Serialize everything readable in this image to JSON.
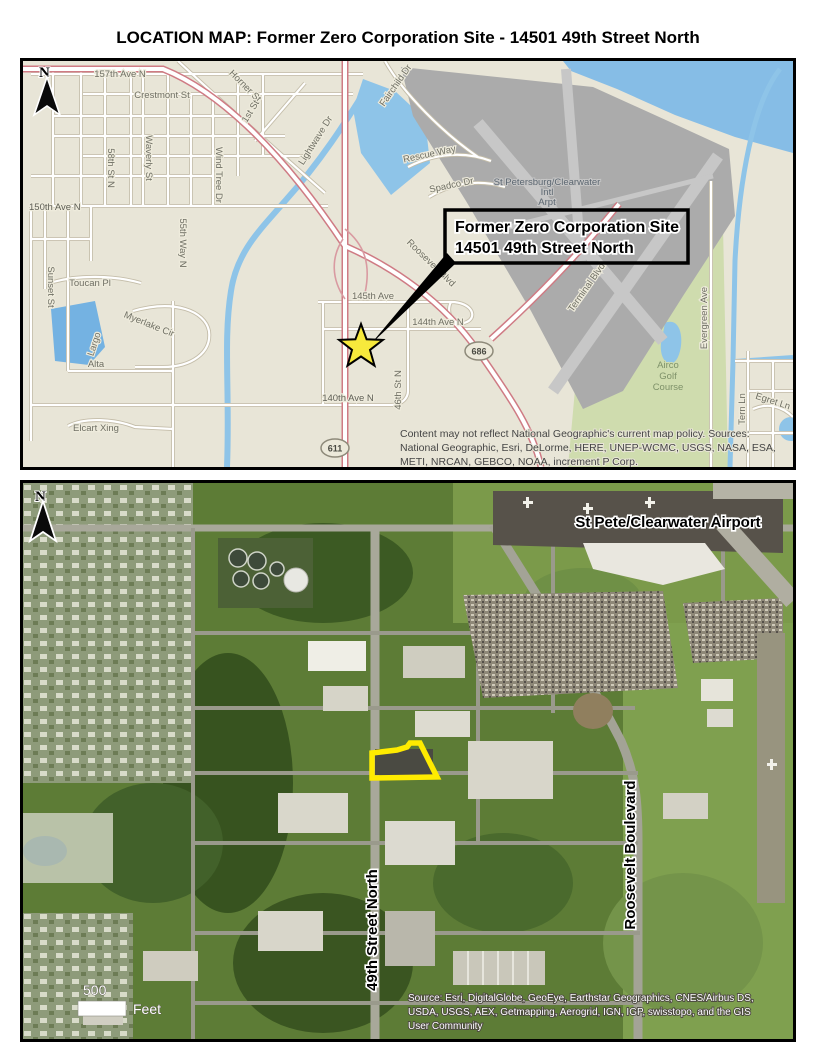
{
  "page": {
    "title": "LOCATION MAP: Former Zero Corporation Site - 14501 49th Street North"
  },
  "colors": {
    "site_outline": "#ffeb00",
    "water": "#86bde6",
    "airport_gray": "#ababab",
    "map_bg": "#e8e5d7",
    "highway_red": "#cf7b84"
  },
  "map1": {
    "north_label": "N",
    "callout": {
      "line1": "Former Zero Corporation Site",
      "line2": "14501 49th Street North"
    },
    "shields": {
      "s686": "686",
      "s611": "611"
    },
    "labels": {
      "ave_157th": "157th Ave N",
      "crestmont": "Crestmont St",
      "horner": "Horner St",
      "first_st": "1st St",
      "st_58th": "58th St N",
      "waverly": "Waverly St",
      "wind_tree": "Wind Tree Dr",
      "way_55th": "55th Way N",
      "ave_150th": "150th Ave N",
      "sunset": "Sunset St",
      "toucan": "Toucan Pl",
      "myerlake": "Myerlake Cir",
      "largo": "Largo",
      "alta": "Alta",
      "elcart": "Elcart Xing",
      "ave_140th": "140th Ave N",
      "st_46th": "46th St N",
      "ave_145th": "145th Ave",
      "ave_144th": "144th Ave N",
      "lightwave": "Lightwave Dr",
      "fairchild": "Fairchild Dr",
      "rescue": "Rescue Way",
      "spadco": "Spadco Dr",
      "roosevelt": "Roosevelt Blvd",
      "terminal": "Terminal Blvd",
      "evergreen": "Evergreen Ave",
      "tern": "Tern Ln",
      "egret": "Egret Ln",
      "airport_line1": "St Petersburg/Clearwater",
      "airport_line2": "Intl",
      "airport_line3": "Arpt",
      "golf_line1": "Airco",
      "golf_line2": "Golf",
      "golf_line3": "Course"
    },
    "attribution": {
      "line1": "Content may not reflect National Geographic's current map policy. Sources:",
      "line2": "National Geographic, Esri, DeLorme, HERE, UNEP-WCMC, USGS, NASA, ESA,",
      "line3": "METI, NRCAN, GEBCO, NOAA, increment P Corp."
    }
  },
  "map2": {
    "north_label": "N",
    "airport_label": "St Pete/Clearwater Airport",
    "street_49th": "49th Street North",
    "roosevelt": "Roosevelt Boulevard",
    "scale": {
      "value": "500",
      "unit": "Feet"
    },
    "attribution": {
      "line1": "Source: Esri, DigitalGlobe, GeoEye, Earthstar Geographics, CNES/Airbus DS,",
      "line2": "USDA, USGS, AEX, Getmapping, Aerogrid, IGN, IGP, swisstopo, and the GIS",
      "line3": "User Community"
    }
  }
}
